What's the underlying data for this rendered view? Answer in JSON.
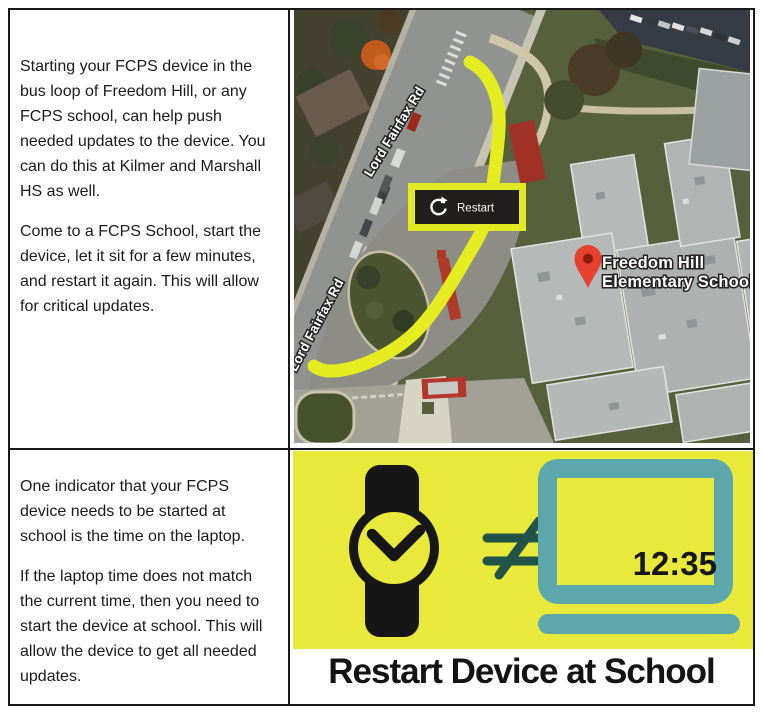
{
  "cells": {
    "restart_instructions": {
      "p1": "Starting your FCPS device in the bus loop of Freedom Hill, or any FCPS school, can help push needed updates to the device. You can do this at Kilmer and Marshall HS as well.",
      "p2": "Come to a FCPS School, start the device, let it sit for a few minutes, and restart it again. This will allow for critical updates."
    },
    "time_instructions": {
      "p1": "One indicator that your FCPS device needs to be started at school is the time on the laptop.",
      "p2": "If the laptop time does not match the current time, then you need to start the device at school. This will allow the device to get all needed updates."
    }
  },
  "map": {
    "road_label_upper": "Lord Fairfax Rd",
    "road_label_lower": "Lord Fairfax Rd",
    "restart_label": "Restart",
    "school_name_line1": "Freedom Hill",
    "school_name_line2": "Elementary School",
    "colors": {
      "highlight_path": "#e5ec1f",
      "pin_red": "#e8402e"
    }
  },
  "graphic": {
    "laptop_time": "12:35",
    "not_equal": "≠",
    "caption": "Restart Device at School",
    "colors": {
      "background": "#e8e93a",
      "laptop_teal": "#5ba7ab",
      "symbol_teal": "#215349",
      "icon_black": "#161616"
    }
  }
}
